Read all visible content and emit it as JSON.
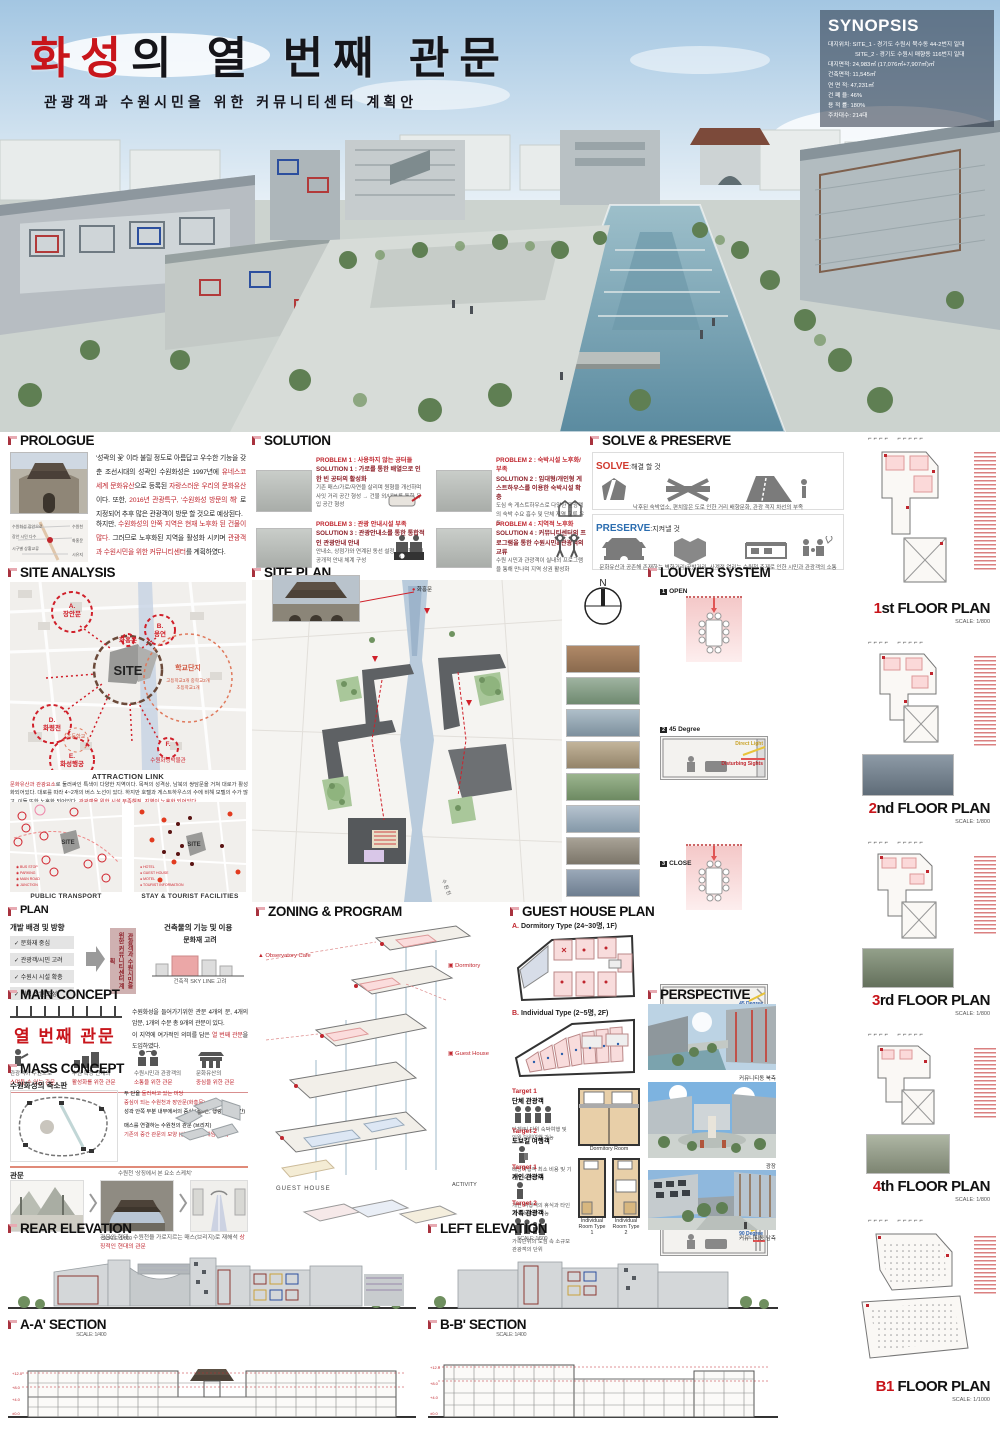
{
  "header": {
    "title_red": "화성",
    "title_black": "의  열  번째  관문",
    "subtitle": "관광객과  수원시민을  위한  커뮤니티센터  계획안"
  },
  "synopsis": {
    "title": "SYNOPSIS",
    "rows": [
      "대지위치: SITE_1 - 경기도 수원시 북수동 44-2번지 일대",
      "SITE_2 - 경기도 수원시 매향동 116번지 일대",
      "대지면적: 24,983㎡ (17,076㎡+7,907㎡)㎡",
      "건축면적: 11,545㎡",
      "연 면 적: 47,231㎡",
      "건 폐 율: 46%",
      "용 적 률: 180%",
      "주차대수: 214대"
    ]
  },
  "prologue": {
    "title": "PROLOGUE",
    "p1a": "'성곽의 꽃' 이라 불릴 정도로 아름답고 우수한 기능을 갖춘 조선시대의 성곽인 수원화성은 1997년에 ",
    "p1b": "유네스코 세계 문화유산",
    "p1c": "으로 등록된 ",
    "p1d": "자랑스러운 우리의 문화유산",
    "p1e": "이다. 또한, ",
    "p1f": "2016년 관광특구, '수원화성 방문의 해'",
    "p1g": " 로 지정되어 추후 많은 관광객이 방문 할 것으로 예상된다.",
    "p2a": "하지만, ",
    "p2b": "수원화성의 안쪽 지역은 현재 노후화 된 건물이 많다.",
    "p2c": " 그러므로 노후화된 지역을 활성화 시키며 ",
    "p2d": "관광객과 수원시민을 위한 커뮤니티센터",
    "p2e": "를 계획하였다."
  },
  "solution": {
    "title": "SOLUTION",
    "items": [
      {
        "problem": "PROBLEM 1 : 사용하지 않는 공터들",
        "solution": "SOLUTION 1 : 가로를 통한 배열으로 인한 빈 공터의 활성화",
        "note": "기존 매스/가로/자연을 살리며 원형을 개선하며 사잇 거리 공간 형성 → 건물 외/내부를 통한 유입 공간 형성"
      },
      {
        "problem": "PROBLEM 2 : 숙박시설 노후화/부족",
        "solution": "SOLUTION 2 : 임대형/개인형 게스트하우스를 이용한 숙박시설 확충",
        "note": "도심 속 게스트하우스로 다양한 관광객의 숙박 수요 흡수 및 단체 지역 교류 유도"
      },
      {
        "problem": "PROBLEM 3 : 관광 안내시설 부족",
        "solution": "SOLUTION 3 : 관광안내소를 통한 통합적인 관광안내 안내",
        "note": "안내소, 상점가와 연계된 동선 설정 → 통합적인 공개적 안내 체계 구성"
      },
      {
        "problem": "PROBLEM 4 : 지역적 노후화",
        "solution": "SOLUTION 4 : 커뮤니티센터의 프로그램을 통한 수원시민&관광객의 교류",
        "note": "수원 시민과 관광객이 실내외 프로그램을 통해 만나며 지역 상권 활성화"
      }
    ]
  },
  "solve_preserve": {
    "title": "SOLVE & PRESERVE",
    "solve_label": "SOLVE",
    "solve_desc": ":해결 할 것",
    "solve_caption": "낙후된 숙박업소,  편치않은 도로 인한 거리 배향문화,  관광 객지 차선의 부족",
    "preserve_label": "PRESERVE",
    "preserve_desc": ":지켜낼 것",
    "preserve_caption": "문화유산과 공존해 존재하는 벽화거리/공방거리,  사계절 열리는 수원천 축제로 인한 시민과 관광객의 소통"
  },
  "site_analysis": {
    "title": "SITE ANALYSIS",
    "site": "SITE",
    "a": "A.\n장안문",
    "b": "B.\n용연",
    "hwahong": "화홍문",
    "d": "D.\n화령전",
    "e": "E.\n화성행궁",
    "f": "F.",
    "museum": "수원화성박물관",
    "school_zone": "학교단지",
    "school_note": "고등학교3개 중학교2개 초등학교1개",
    "elementary": "초등학교",
    "attraction_title": "ATTRACTION LINK",
    "att_r1": "문화유산과 관광요소",
    "att_b1": "로 둘러싸인 특색이 다양한 지역이다. 목적의 성격상, 남북의 쌍담문을 거쳐 대로가 활성화되어있다. 대로를 따라 4~2개의 버스 노선이 있다. 하지만 호텔과 게스트하우스의 수에 비해 모텔의 수가 많고, 이들 또한 노후화 되어있다. ",
    "att_r2": "관광객을 위한 시설 부족해짐, 지역이 노후화 되어있다.",
    "map1_caption": "PUBLIC TRANSPORT",
    "map2_caption": "STAY & TOURIST FACILITIES"
  },
  "site_plan": {
    "title": "SITE PLAN",
    "photo_label": "화홍문",
    "north": "N"
  },
  "louver": {
    "title": "LOUVER SYSTEM",
    "i1_num": "1",
    "i1_label": "OPEN",
    "i1_note_a": "Direct Light",
    "i1_note_b": "Disturbing Sights",
    "i2_num": "2",
    "i2_label": "45 Degree",
    "i2_note": "45 Degree",
    "i3_num": "3",
    "i3_label": "CLOSE",
    "i3_note": "90 Degree"
  },
  "floor_plans": [
    {
      "num": "1",
      "ord": "st",
      "rest": " FLOOR PLAN",
      "scale": "SCALE: 1/800"
    },
    {
      "num": "2",
      "ord": "nd",
      "rest": " FLOOR PLAN",
      "scale": "SCALE: 1/800"
    },
    {
      "num": "3",
      "ord": "rd",
      "rest": " FLOOR PLAN",
      "scale": "SCALE: 1/800"
    },
    {
      "num": "4",
      "ord": "th",
      "rest": " FLOOR PLAN",
      "scale": "SCALE: 1/800"
    },
    {
      "num": "B1",
      "ord": "",
      "rest": " FLOOR PLAN",
      "scale": "SCALE: 1/1000"
    }
  ],
  "plan": {
    "title": "PLAN",
    "left_title": "개발 배경 및 방향",
    "check1": "문화재 중심",
    "check2": "관광객/시민 고려",
    "check3": "수원시 시설 확충",
    "check4": "지역 상권 조성",
    "arrow_box": "관광객과 수원시민을 위한 커뮤니티센터 계획",
    "right_title": "건축물의 기능 및 이용",
    "col1_head": "문화재 고려",
    "col1_cap": "건축적 SKY LINE 고려",
    "col2_head": "수원화성 내부로 유입",
    "col2_cap": "관광객, 시민 유동시설 확충",
    "col3_head": "거리 활성화",
    "col3_cap": "기존의 골목을 고려한 설계"
  },
  "main_concept": {
    "title": "MAIN CONCEPT",
    "keyword": "열 번째 관문",
    "d1": "수원화성을 들어가기위한 관문 4개의 문, 4개의 암문, 1개의 수문 총 9개의 관문이 있다.",
    "d2a": "이 지역에 여가적인 의미를 담은 ",
    "d2b": "열 번째 관문",
    "d2c": "을 도입하였다.",
    "ic1a": "관광객이 수원으로",
    "ic1b": "스며들 수 있는 관문",
    "ic2a": "수원 확장 단계의",
    "ic2b": "활성화를 위한 관문",
    "ic3a": "수원시민과 관광객의",
    "ic3b": "소통을 위한 관문",
    "ic4a": "문화유산의",
    "ic4b": "중심을 위한 관문"
  },
  "mass_concept": {
    "title": "MASS CONCEPT",
    "sub1": "수원화성의 축소판",
    "n1a": "두 단을 ",
    "n1b": "둘러싸고 있는 마당",
    "n2": "중심이 되는 수원천과 장안문(화홍문)",
    "n3": "성곽 안쪽 부분 내부에서의 중심 (폭4간, 행랑3간, 85간)",
    "n4a": "사이트를 ",
    "n4b": "둘러싼",
    " n4c": " 형태의 매스",
    "n5": "매스를 연결하는 수원천의 관문 (브리지)",
    "n6": "기존의 중간 관문의 모양 (상가, 백화, 게임/가게)",
    "sub2": "관문",
    "n7": "수원천 '상징에서 본 요소 스케치'",
    "n8": "관문의 형태 : 수원천을 가로지르는 매스(브리지)로 재해석",
    "n9": "상징적인 현대의 관문"
  },
  "zoning": {
    "title": "ZONING & PROGRAM",
    "l1": "Observatory Cafe",
    "l2": "Dormitory",
    "l3": "Guest House",
    "l4": "GUEST HOUSE",
    "l5": "ACTIVITY"
  },
  "guest_house": {
    "title": "GUEST HOUSE PLAN",
    "type_a_r": "A.",
    "type_a": " Dormitory Type (24~30명, 1F)",
    "type_b_r": "B.",
    "type_b": " Individual Type (2~5명, 2F)",
    "t1_tag": "Target 1",
    "t1_who": "단체 관광객",
    "t1_desc": "단체/팀 단위 숙박여행 및 인원 단위여행 가능",
    "t2_tag": "Target 2",
    "t2_who": "도보길 여행객",
    "t2_desc": "배낭여행객 최소 비용 및 기본적 숙식 가능",
    "t3_tag": "Target 1",
    "t3_who": "개인 관광객",
    "t3_desc": "개인 여행객의 휴식과 타인과 친목교류 가능",
    "t4_tag": "Target 2",
    "t4_who": "가족 관광객",
    "t4_desc": "가족단위의 도심 속 소규모 관광객의 단위",
    "room1": "Dormitory Room",
    "room2": "Individual Room Type 1",
    "room3": "Individual Room Type 2"
  },
  "perspective": {
    "title": "PERSPECTIVE",
    "cap1": "커뮤니티동 북측",
    "cap2": "광장",
    "cap3": "커뮤니티동 남측"
  },
  "elevations": {
    "rear_title": "REAR ELEVATION",
    "rear_scale": "SCALE: 1/600",
    "left_title": "LEFT ELEVATION",
    "left_scale": "SCALE: 1/600",
    "aa_title": "A-A'  SECTION",
    "aa_scale": "SCALE: 1/400",
    "bb_title": "B-B'  SECTION",
    "bb_scale": "SCALE: 1/400"
  }
}
